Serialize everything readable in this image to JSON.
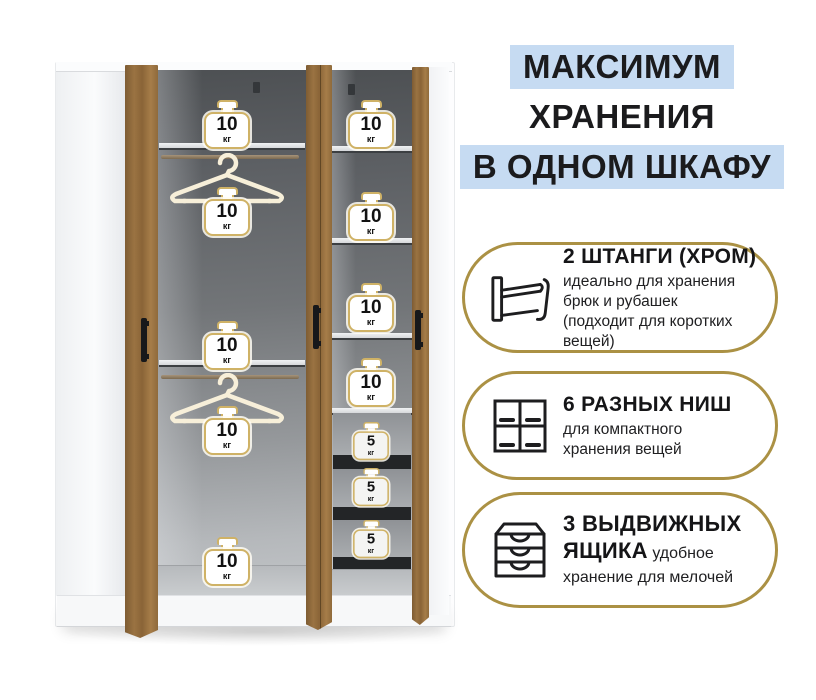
{
  "header": {
    "line1": "МАКСИМУМ",
    "line2": "ХРАНЕНИЯ",
    "line3": "В ОДНОМ ШКАФУ"
  },
  "features": [
    {
      "icon": "clothes-rail-icon",
      "title": "2 ШТАНГИ (ХРОМ)",
      "description": "идеально для хранения брюк и рубашек (подходит для коротких вещей)"
    },
    {
      "icon": "niches-icon",
      "title": "6 РАЗНЫХ НИШ",
      "description": "для компактного хранения вещей"
    },
    {
      "icon": "drawers-icon",
      "title": "3 ВЫДВИЖНЫХ ЯЩИКА",
      "description": "удобное хранение для мелочей"
    }
  ],
  "wardrobe": {
    "left_labels": [
      {
        "value": "10",
        "unit": "кг"
      },
      {
        "value": "10",
        "unit": "кг"
      },
      {
        "value": "10",
        "unit": "кг"
      },
      {
        "value": "10",
        "unit": "кг"
      },
      {
        "value": "10",
        "unit": "кг"
      }
    ],
    "right_labels": [
      {
        "value": "10",
        "unit": "кг"
      },
      {
        "value": "10",
        "unit": "кг"
      },
      {
        "value": "10",
        "unit": "кг"
      },
      {
        "value": "10",
        "unit": "кг"
      }
    ],
    "drawer_labels": [
      {
        "value": "5",
        "unit": "кг"
      },
      {
        "value": "5",
        "unit": "кг"
      },
      {
        "value": "5",
        "unit": "кг"
      }
    ]
  },
  "colors": {
    "highlight_blue": "#c6dbf2",
    "gold_border": "#ab9144",
    "badge_border": "#cfb266",
    "wood": "#9a7342",
    "interior_dark": "#4d5053",
    "text": "#1d1d1f"
  }
}
